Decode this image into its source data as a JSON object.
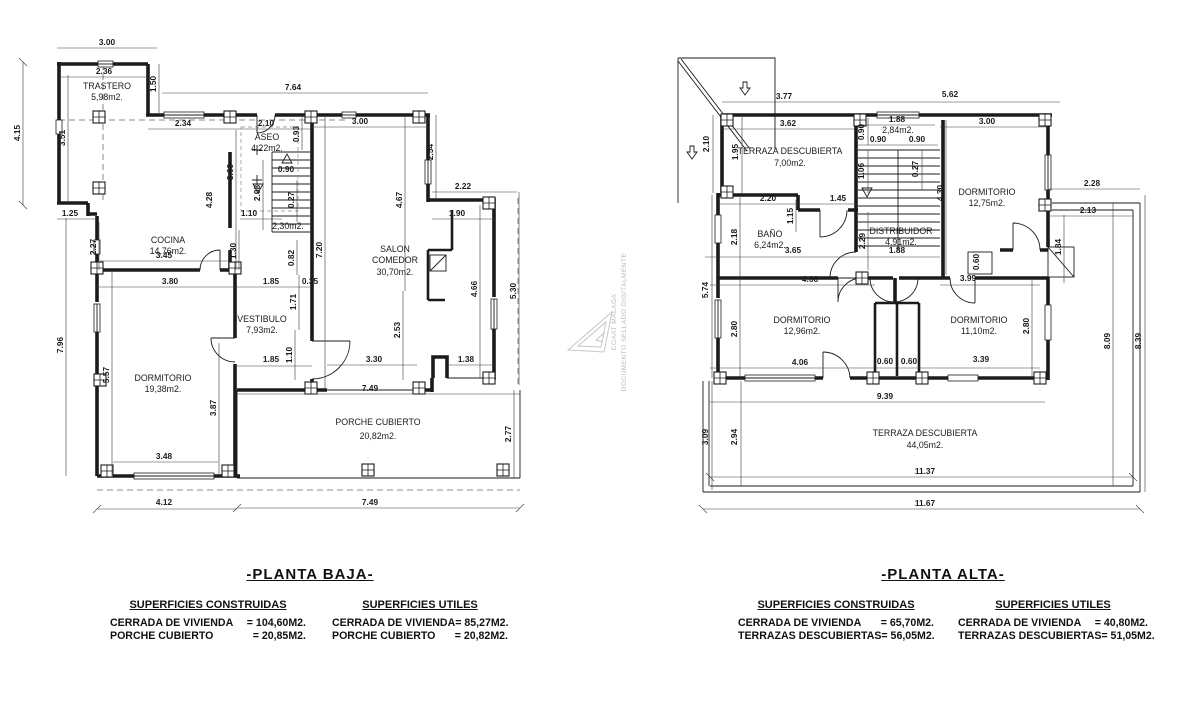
{
  "watermark": {
    "org": "COAAT MALAGA",
    "stamp": "DOCUMENTO SELLADO DIGITALMENTE"
  },
  "planta_baja": {
    "labels": [
      {
        "t": "TRASTERO",
        "x": 107,
        "y": 89,
        "k": "r"
      },
      {
        "t": "5,98m2.",
        "x": 107,
        "y": 100,
        "k": "r"
      },
      {
        "t": "COCINA",
        "x": 168,
        "y": 243,
        "k": "r"
      },
      {
        "t": "14,76m2.",
        "x": 168,
        "y": 254,
        "k": "r"
      },
      {
        "t": "ASEO",
        "x": 267,
        "y": 140,
        "k": "r"
      },
      {
        "t": "4,22m2.",
        "x": 267,
        "y": 151,
        "k": "r"
      },
      {
        "t": "2,30m2.",
        "x": 288,
        "y": 229,
        "k": "r",
        "s": 7.4
      },
      {
        "t": "SALON",
        "x": 395,
        "y": 252,
        "k": "r"
      },
      {
        "t": "COMEDOR",
        "x": 395,
        "y": 263,
        "k": "r"
      },
      {
        "t": "30,70m2.",
        "x": 395,
        "y": 275,
        "k": "r"
      },
      {
        "t": "VESTIBULO",
        "x": 262,
        "y": 322,
        "k": "r"
      },
      {
        "t": "7,93m2.",
        "x": 262,
        "y": 333,
        "k": "r"
      },
      {
        "t": "DORMITORIO",
        "x": 163,
        "y": 381,
        "k": "r"
      },
      {
        "t": "19,38m2.",
        "x": 163,
        "y": 392,
        "k": "r"
      },
      {
        "t": "PORCHE CUBIERTO",
        "x": 378,
        "y": 425,
        "k": "r"
      },
      {
        "t": "20,82m2.",
        "x": 378,
        "y": 439,
        "k": "r"
      },
      {
        "t": "3.00",
        "x": 107,
        "y": 45
      },
      {
        "t": "2.36",
        "x": 104,
        "y": 74
      },
      {
        "t": "7.64",
        "x": 293,
        "y": 90
      },
      {
        "t": "2.34",
        "x": 183,
        "y": 126
      },
      {
        "t": "2.10",
        "x": 266,
        "y": 126
      },
      {
        "t": "3.00",
        "x": 360,
        "y": 124
      },
      {
        "t": "0.90",
        "x": 286,
        "y": 172
      },
      {
        "t": "1.10",
        "x": 249,
        "y": 216
      },
      {
        "t": "3.45",
        "x": 164,
        "y": 258
      },
      {
        "t": "3.80",
        "x": 170,
        "y": 284
      },
      {
        "t": "1.85",
        "x": 271,
        "y": 284
      },
      {
        "t": "0.35",
        "x": 310,
        "y": 284
      },
      {
        "t": "1.85",
        "x": 271,
        "y": 362
      },
      {
        "t": "2.22",
        "x": 463,
        "y": 189
      },
      {
        "t": "1.90",
        "x": 457,
        "y": 216
      },
      {
        "t": "3.30",
        "x": 374,
        "y": 362
      },
      {
        "t": "1.38",
        "x": 466,
        "y": 362
      },
      {
        "t": "3.48",
        "x": 164,
        "y": 459
      },
      {
        "t": "4.12",
        "x": 164,
        "y": 505
      },
      {
        "t": "7.49",
        "x": 370,
        "y": 391
      },
      {
        "t": "7.49",
        "x": 370,
        "y": 505
      },
      {
        "t": "1.25",
        "x": 70,
        "y": 216
      },
      {
        "t": "4.15",
        "x": 20,
        "y": 133,
        "r": 1
      },
      {
        "t": "3.51",
        "x": 65,
        "y": 138,
        "r": 1
      },
      {
        "t": "1.50",
        "x": 156,
        "y": 84,
        "r": 1
      },
      {
        "t": "2.27",
        "x": 96,
        "y": 247,
        "r": 1
      },
      {
        "t": "7.96",
        "x": 63,
        "y": 345,
        "r": 1
      },
      {
        "t": "5.57",
        "x": 109,
        "y": 375,
        "r": 1
      },
      {
        "t": "3.87",
        "x": 216,
        "y": 408,
        "r": 1
      },
      {
        "t": "0.93",
        "x": 299,
        "y": 134,
        "r": 1
      },
      {
        "t": "3.60",
        "x": 233,
        "y": 172,
        "r": 1
      },
      {
        "t": "4.28",
        "x": 212,
        "y": 200,
        "r": 1
      },
      {
        "t": "2.08",
        "x": 260,
        "y": 193,
        "r": 1
      },
      {
        "t": "0.27",
        "x": 294,
        "y": 200,
        "r": 1
      },
      {
        "t": "1.30",
        "x": 236,
        "y": 251,
        "r": 1
      },
      {
        "t": "7.20",
        "x": 322,
        "y": 250,
        "r": 1
      },
      {
        "t": "0.82",
        "x": 294,
        "y": 258,
        "r": 1
      },
      {
        "t": "1.71",
        "x": 296,
        "y": 302,
        "r": 1
      },
      {
        "t": "1.10",
        "x": 292,
        "y": 355,
        "r": 1
      },
      {
        "t": "2.54",
        "x": 433,
        "y": 152,
        "r": 1
      },
      {
        "t": "4.67",
        "x": 402,
        "y": 200,
        "r": 1
      },
      {
        "t": "2.53",
        "x": 400,
        "y": 330,
        "r": 1
      },
      {
        "t": "4.66",
        "x": 477,
        "y": 289,
        "r": 1
      },
      {
        "t": "5.30",
        "x": 516,
        "y": 291,
        "r": 1
      },
      {
        "t": "2.77",
        "x": 511,
        "y": 434,
        "r": 1
      }
    ]
  },
  "planta_alta": {
    "labels": [
      {
        "t": "TERRAZA DESCUBIERTA",
        "x": 790,
        "y": 154,
        "k": "r"
      },
      {
        "t": "7,00m2.",
        "x": 790,
        "y": 166,
        "k": "r"
      },
      {
        "t": "BAÑO",
        "x": 770,
        "y": 237,
        "k": "r"
      },
      {
        "t": "6,24m2.",
        "x": 770,
        "y": 248,
        "k": "r"
      },
      {
        "t": "DISTRIBUIDOR",
        "x": 901,
        "y": 234,
        "k": "r"
      },
      {
        "t": "4,91m2.",
        "x": 901,
        "y": 245,
        "k": "r"
      },
      {
        "t": "2,84m2.",
        "x": 898,
        "y": 133,
        "k": "r",
        "s": 7.4
      },
      {
        "t": "DORMITORIO",
        "x": 987,
        "y": 195,
        "k": "r"
      },
      {
        "t": "12,75m2.",
        "x": 987,
        "y": 206,
        "k": "r"
      },
      {
        "t": "DORMITORIO",
        "x": 802,
        "y": 323,
        "k": "r"
      },
      {
        "t": "12,96m2.",
        "x": 802,
        "y": 334,
        "k": "r"
      },
      {
        "t": "DORMITORIO",
        "x": 979,
        "y": 323,
        "k": "r"
      },
      {
        "t": "11,10m2.",
        "x": 979,
        "y": 334,
        "k": "r"
      },
      {
        "t": "TERRAZA DESCUBIERTA",
        "x": 925,
        "y": 436,
        "k": "r"
      },
      {
        "t": "44,05m2.",
        "x": 925,
        "y": 448,
        "k": "r"
      },
      {
        "t": "3.77",
        "x": 784,
        "y": 99
      },
      {
        "t": "5.62",
        "x": 950,
        "y": 97
      },
      {
        "t": "3.62",
        "x": 788,
        "y": 126
      },
      {
        "t": "1.88",
        "x": 897,
        "y": 122
      },
      {
        "t": "0.90",
        "x": 878,
        "y": 142
      },
      {
        "t": "0.90",
        "x": 917,
        "y": 142
      },
      {
        "t": "3.00",
        "x": 987,
        "y": 124
      },
      {
        "t": "2.28",
        "x": 1092,
        "y": 186
      },
      {
        "t": "2.13",
        "x": 1088,
        "y": 213
      },
      {
        "t": "2.20",
        "x": 768,
        "y": 201
      },
      {
        "t": "1.45",
        "x": 838,
        "y": 201
      },
      {
        "t": "3.65",
        "x": 793,
        "y": 253
      },
      {
        "t": "1.88",
        "x": 897,
        "y": 253
      },
      {
        "t": "4.66",
        "x": 810,
        "y": 282
      },
      {
        "t": "3.99",
        "x": 968,
        "y": 281
      },
      {
        "t": "4.06",
        "x": 800,
        "y": 365
      },
      {
        "t": "0.60",
        "x": 885,
        "y": 364
      },
      {
        "t": "0.60",
        "x": 909,
        "y": 364
      },
      {
        "t": "3.39",
        "x": 981,
        "y": 362
      },
      {
        "t": "9.39",
        "x": 885,
        "y": 399
      },
      {
        "t": "11.37",
        "x": 925,
        "y": 474
      },
      {
        "t": "11.67",
        "x": 925,
        "y": 506
      },
      {
        "t": "2.10",
        "x": 709,
        "y": 144,
        "r": 1
      },
      {
        "t": "1.95",
        "x": 738,
        "y": 152,
        "r": 1
      },
      {
        "t": "0.90",
        "x": 864,
        "y": 132,
        "r": 1
      },
      {
        "t": "1.06",
        "x": 864,
        "y": 171,
        "r": 1
      },
      {
        "t": "0.27",
        "x": 918,
        "y": 169,
        "r": 1
      },
      {
        "t": "4.30",
        "x": 943,
        "y": 193,
        "r": 1
      },
      {
        "t": "1.15",
        "x": 793,
        "y": 216,
        "r": 1
      },
      {
        "t": "2.18",
        "x": 737,
        "y": 237,
        "r": 1
      },
      {
        "t": "2.29",
        "x": 865,
        "y": 241,
        "r": 1
      },
      {
        "t": "1.84",
        "x": 1061,
        "y": 247,
        "r": 1
      },
      {
        "t": "0.60",
        "x": 979,
        "y": 262,
        "r": 1
      },
      {
        "t": "5.74",
        "x": 708,
        "y": 290,
        "r": 1
      },
      {
        "t": "2.80",
        "x": 737,
        "y": 329,
        "r": 1
      },
      {
        "t": "2.80",
        "x": 1029,
        "y": 326,
        "r": 1
      },
      {
        "t": "3.09",
        "x": 708,
        "y": 437,
        "r": 1
      },
      {
        "t": "2.94",
        "x": 737,
        "y": 437,
        "r": 1
      },
      {
        "t": "8.09",
        "x": 1110,
        "y": 341,
        "r": 1
      },
      {
        "t": "8.39",
        "x": 1141,
        "y": 341,
        "r": 1
      }
    ]
  },
  "footer_baja": {
    "title": "-PLANTA BAJA-",
    "constructed": {
      "heading": "SUPERFICIES CONSTRUIDAS",
      "rows": [
        {
          "label": "CERRADA DE VIVIENDA",
          "value": "= 104,60M2."
        },
        {
          "label": "PORCHE CUBIERTO",
          "value": "= 20,85M2."
        }
      ]
    },
    "useful": {
      "heading": "SUPERFICIES UTILES",
      "rows": [
        {
          "label": "CERRADA DE VIVIENDA",
          "value": "= 85,27M2."
        },
        {
          "label": "PORCHE CUBIERTO",
          "value": "= 20,82M2."
        }
      ]
    }
  },
  "footer_alta": {
    "title": "-PLANTA ALTA-",
    "constructed": {
      "heading": "SUPERFICIES CONSTRUIDAS",
      "rows": [
        {
          "label": "CERRADA DE VIVIENDA",
          "value": "= 65,70M2."
        },
        {
          "label": "TERRAZAS DESCUBIERTAS",
          "value": "= 56,05M2."
        }
      ]
    },
    "useful": {
      "heading": "SUPERFICIES UTILES",
      "rows": [
        {
          "label": "CERRADA DE VIVIENDA",
          "value": "= 40,80M2."
        },
        {
          "label": "TERRAZAS DESCUBIERTAS",
          "value": "= 51,05M2."
        }
      ]
    }
  }
}
